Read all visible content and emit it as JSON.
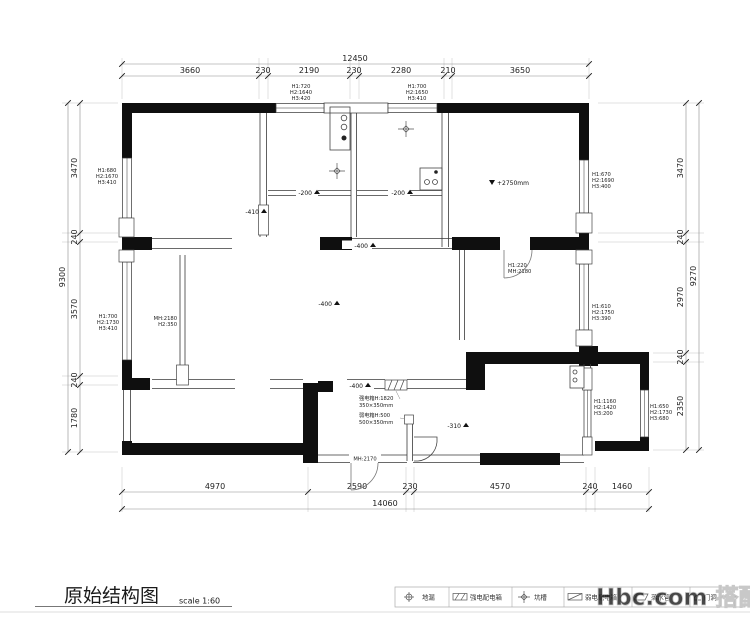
{
  "meta": {
    "title": "原始结构图",
    "scale": "scale 1:60",
    "watermark": "Hbc.com 搭配网"
  },
  "dims": {
    "top": {
      "total": "12450",
      "segments": [
        "3660",
        "230",
        "2190",
        "230",
        "2280",
        "210",
        "3650"
      ]
    },
    "bottom": {
      "total": "14060",
      "segments": [
        "4970",
        "2590",
        "230",
        "4570",
        "240",
        "1460"
      ]
    },
    "left": {
      "total": "9300",
      "segments": [
        "3470",
        "240",
        "3570",
        "240",
        "1780"
      ]
    },
    "right": {
      "total": "9270",
      "segments": [
        "3470",
        "240",
        "2970",
        "240",
        "2350"
      ]
    }
  },
  "windows": [
    {
      "id": "top-wall-left",
      "h1": "H1:720",
      "h2": "H2:1640",
      "h3": "H3:420"
    },
    {
      "id": "top-wall-right",
      "h1": "H1:700",
      "h2": "H2:1650",
      "h3": "H3:410"
    },
    {
      "id": "left-wall-upper",
      "h1": "H1:680",
      "h2": "H2:1670",
      "h3": "H3:410"
    },
    {
      "id": "left-wall-lower",
      "h1": "H1:700",
      "h2": "H2:1730",
      "h3": "H3:410"
    },
    {
      "id": "right-wall-upper",
      "h1": "H1:670",
      "h2": "H2:1690",
      "h3": "H3:400"
    },
    {
      "id": "right-wall-middle",
      "h1": "H1:610",
      "h2": "H2:1750",
      "h3": "H3:390"
    },
    {
      "id": "bath-interior",
      "h1": "H1:1160",
      "h2": "H2:1420",
      "h3": "H3:200"
    },
    {
      "id": "far-right",
      "h1": "H1:650",
      "h2": "H2:1730",
      "h3": "H3:680"
    }
  ],
  "doors": {
    "bath_door": {
      "l1": "H1:220",
      "l2": "MH:2180"
    },
    "living_opening": {
      "l1": "MH:2180",
      "l2": "H2:350"
    },
    "entry_door": "MH:2170"
  },
  "levels": {
    "room_a": "-200",
    "room_b": "-200",
    "bedroom": "-410",
    "corridor": "-400",
    "living": "-400",
    "entry": "-400",
    "bath": "-310",
    "ceiling": "+2750mm"
  },
  "equipment": {
    "strong_box": {
      "l1": "强电箱H:1820",
      "l2": "350×350mm"
    },
    "weak_box": {
      "l1": "弱电箱H:500",
      "l2": "500×350mm"
    }
  },
  "legend": {
    "items": [
      {
        "icon": "floor-drain-icon",
        "label": "地漏"
      },
      {
        "icon": "strong-power-box-icon",
        "label": "强电配电箱"
      },
      {
        "icon": "pit-trench-icon",
        "label": "坑槽"
      },
      {
        "icon": "weak-power-box-icon",
        "label": "弱电配电箱"
      },
      {
        "icon": "downpipe-icon",
        "label": "落水管"
      },
      {
        "icon": "door-opening-icon",
        "label": "门洞"
      }
    ]
  }
}
